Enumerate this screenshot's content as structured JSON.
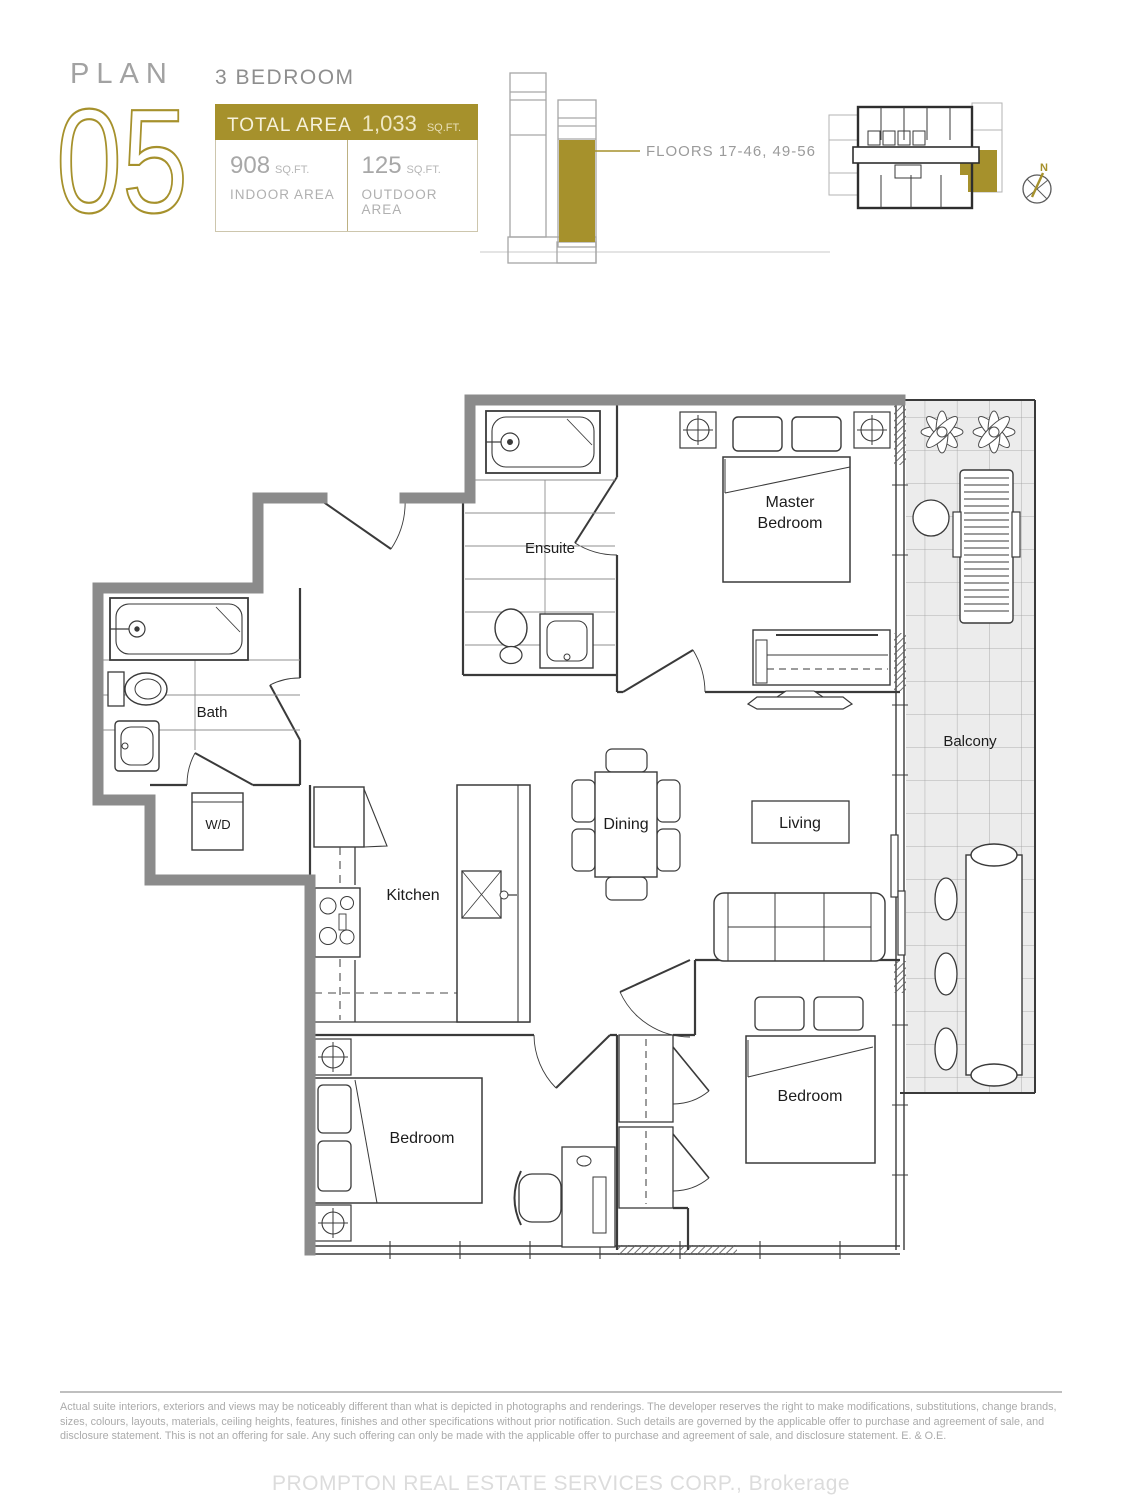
{
  "header": {
    "plan_label": "PLAN",
    "plan_number": "05",
    "unit_type": "3 BEDROOM",
    "total_area_label": "TOTAL AREA",
    "total_area_value": "1,033",
    "area_unit": "SQ.FT.",
    "indoor_value": "908",
    "indoor_label": "INDOOR AREA",
    "outdoor_value": "125",
    "outdoor_label": "OUTDOOR AREA"
  },
  "elevation": {
    "floors_label": "FLOORS 17-46, 49-56"
  },
  "keyplan": {
    "north_label": "N"
  },
  "plan": {
    "rooms": {
      "ensuite": "Ensuite",
      "master_line1": "Master",
      "master_line2": "Bedroom",
      "bath": "Bath",
      "wd": "W/D",
      "kitchen": "Kitchen",
      "dining": "Dining",
      "living": "Living",
      "balcony": "Balcony",
      "bedroom_left": "Bedroom",
      "bedroom_right": "Bedroom"
    }
  },
  "footer": {
    "disclaimer": "Actual suite interiors, exteriors and views may be noticeably different than what is depicted in photographs and renderings. The developer reserves the right to make modifications, substitutions, change brands, sizes, colours, layouts, materials, ceiling heights, features, finishes and other specifications without prior notification. Such details are governed by the applicable offer to purchase and agreement of sale, and disclosure statement. This is not an offering for sale. Any such offering can only be made with the applicable offer to purchase and agreement of sale, and disclosure statement. E. & O.E.",
    "brokerage": "PROMPTON REAL ESTATE SERVICES CORP., Brokerage"
  },
  "colors": {
    "accent_gold": "#A6912C",
    "wall_gray": "#8b8b8b",
    "line": "#3a3a3a"
  }
}
